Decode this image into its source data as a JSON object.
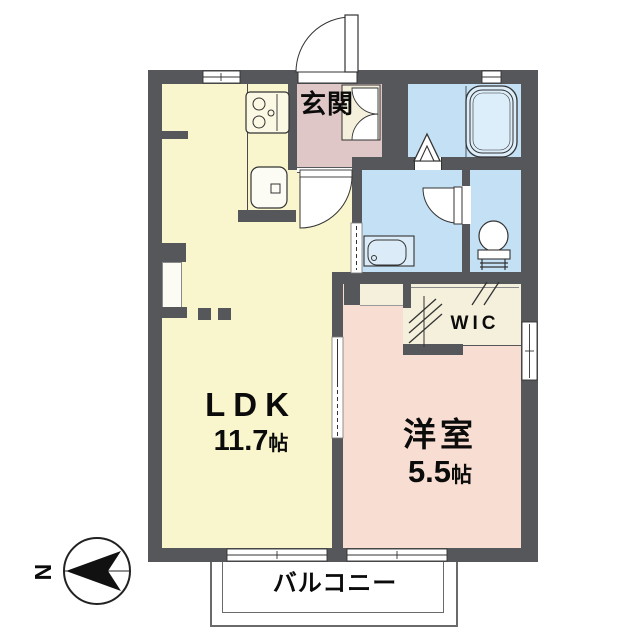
{
  "floorplan": {
    "rooms": {
      "entrance": {
        "label": "玄関"
      },
      "ldk": {
        "label": "LDK",
        "area_value": "11.7",
        "area_unit": "帖"
      },
      "western_room": {
        "label": "洋室",
        "area_value": "5.5",
        "area_unit": "帖"
      },
      "wic": {
        "label": "WIC"
      },
      "balcony": {
        "label": "バルコニー"
      }
    },
    "compass": {
      "label": "N",
      "arrow_points": "left"
    },
    "fixtures": [
      "bathtub-icon",
      "folding-bath-door-icon",
      "toilet-icon",
      "washbasin-icon",
      "gas-stove-icon",
      "kitchen-sink-icon",
      "door-swing-icon",
      "sliding-door-icon",
      "hanger-pipe-icon",
      "north-arrow-icon"
    ],
    "colors": {
      "wall": "#56575b",
      "ldk_floor": "#f9f6cd",
      "entrance_floor": "#dec7c6",
      "western_room_floor": "#f8ded2",
      "wet_area_floor": "#c4e0f5",
      "closet_floor": "#f5f0dc",
      "outline": "#333333"
    }
  }
}
